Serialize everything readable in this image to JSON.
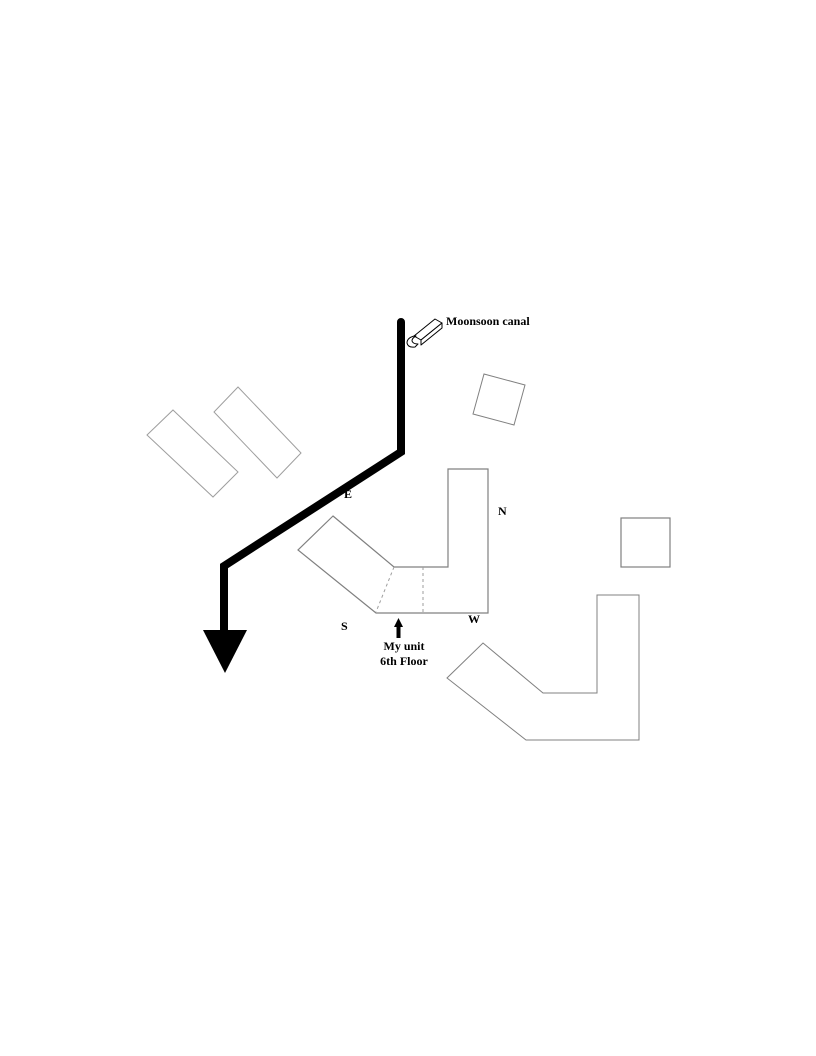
{
  "diagram": {
    "canal_label": "Moonsoon canal",
    "compass": {
      "east": "E",
      "north": "N",
      "west": "W",
      "south": "S"
    },
    "unit_annotation": {
      "line1": "My unit",
      "line2": "6th Floor"
    }
  },
  "icons": {
    "canal_flow": "canal-flow-3d-arrow-icon",
    "canal_direction": "canal-direction-arrowhead-icon",
    "unit_pointer": "unit-pointer-arrow-icon"
  },
  "colors": {
    "background": "#ffffff",
    "canal": "#000000",
    "text": "#000000",
    "building_outline": "#808080",
    "light_building_outline": "#9e9e9e",
    "dashed_divider": "#9e9e9e",
    "building_fill": "#ffffff"
  }
}
